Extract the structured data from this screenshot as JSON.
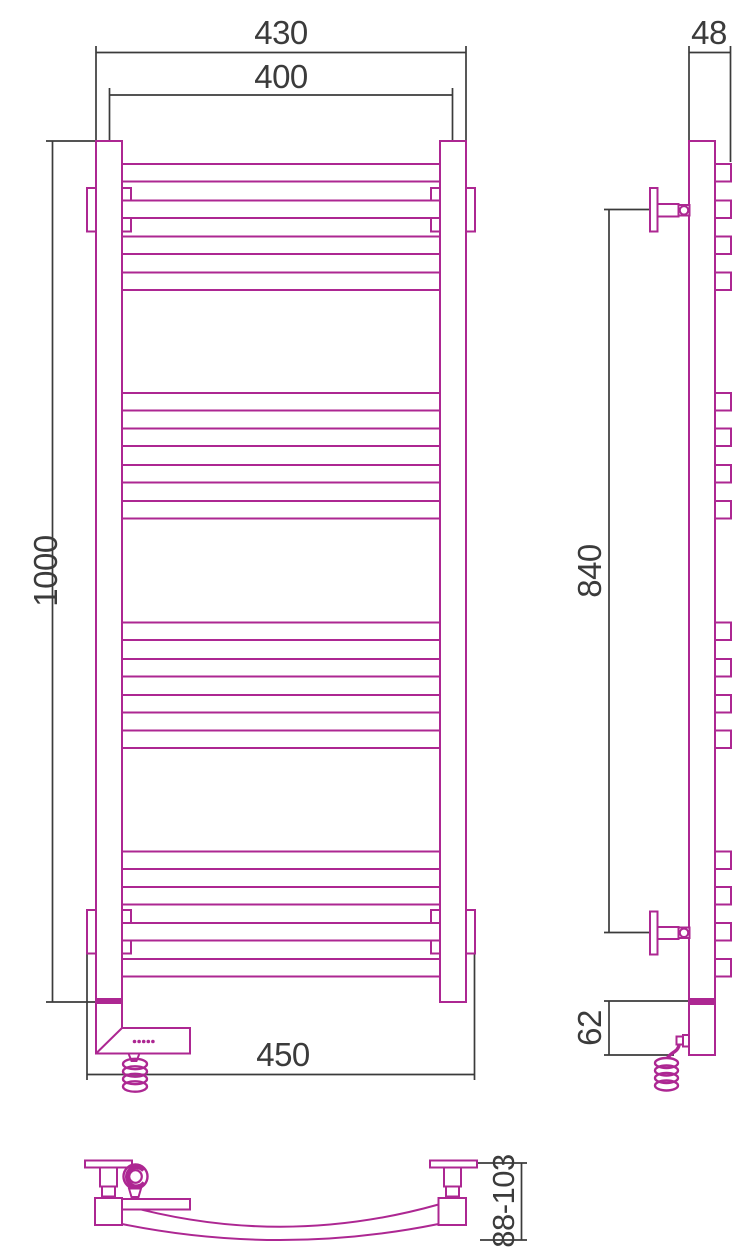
{
  "drawing": {
    "type": "technical-dimension-drawing",
    "subject": "ladder towel rail with electric heater, three orthographic views",
    "colors": {
      "product_outline": "#ad2792",
      "dimension_lines": "#3b3b3b",
      "background": "#ffffff"
    },
    "dims": {
      "outer_width": "430",
      "center_width": "400",
      "depth": "48",
      "height": "1000",
      "mount_span": "840",
      "bottom_span": "450",
      "heater_height": "62",
      "wall_distance": "88-103"
    }
  }
}
